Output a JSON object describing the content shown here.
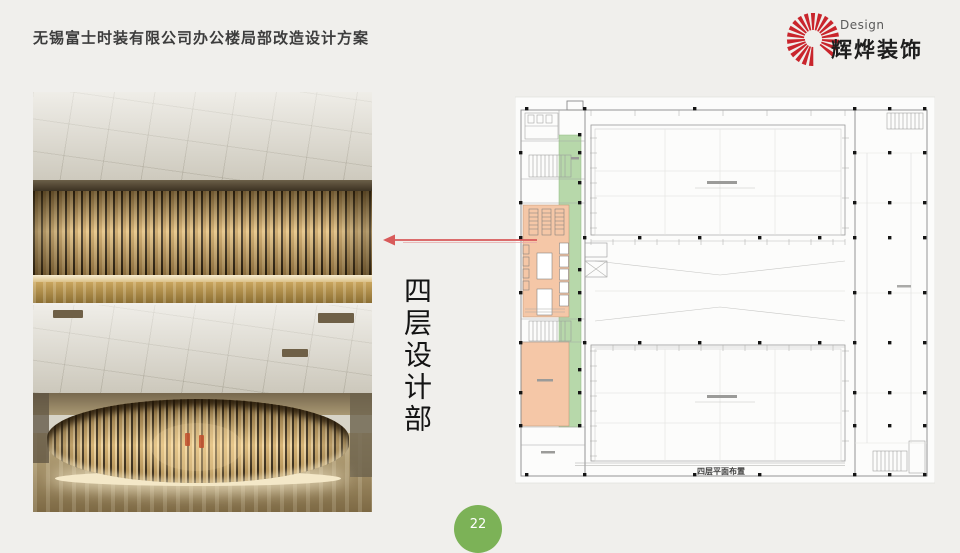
{
  "header": {
    "title": "无锡富士时装有限公司办公楼局部改造设计方案"
  },
  "logo": {
    "design_label": "Design",
    "company": "辉烨装饰",
    "icon": "sunburst-icon",
    "icon_color": "#c9252c"
  },
  "content": {
    "section_vertical_label": "四层设计部",
    "photo_1": "wood-slat-partition-closeup-photo",
    "photo_2": "wood-slat-enclosure-room-photo"
  },
  "arrow": {
    "icon": "left-arrow-icon",
    "color": "#d85a5a"
  },
  "plan": {
    "caption": "四层平面布置",
    "corridor_color": "#b7d8aa",
    "room_highlight_color": "#f5c7a7"
  },
  "footer": {
    "page_number": "22",
    "badge_color": "#7cb257"
  }
}
